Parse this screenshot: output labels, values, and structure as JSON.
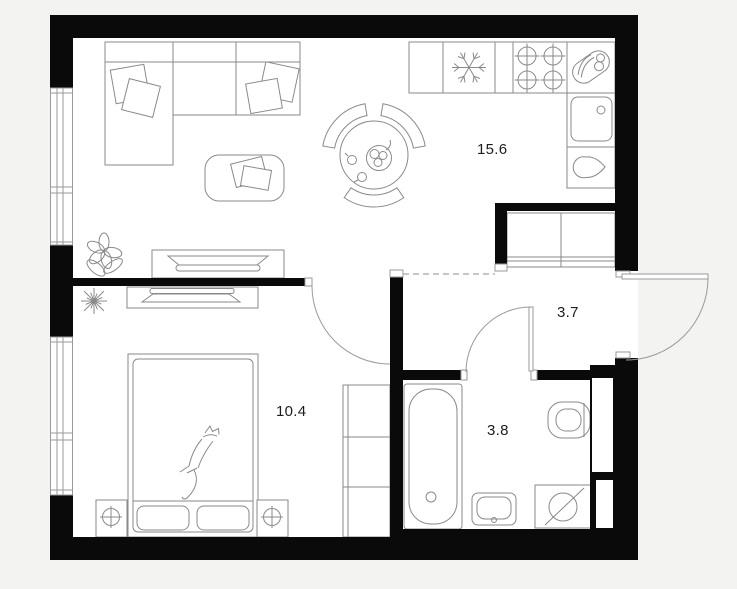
{
  "rooms": [
    {
      "name": "living-room-with-kitchen",
      "area_label": "15.6"
    },
    {
      "name": "bedroom",
      "area_label": "10.4"
    },
    {
      "name": "hallway",
      "area_label": "3.7"
    },
    {
      "name": "bathroom",
      "area_label": "3.8"
    }
  ],
  "colors": {
    "background": "#f3f3f1",
    "floor": "#ffffff",
    "walls": "#0a0a0a",
    "furniture_lines": "#8a8a8a",
    "labels": "#1d1d1d"
  },
  "icons": {
    "kitchen": [
      "fridge-icon",
      "stove-burners-icon",
      "kitchen-sink-icon",
      "kettle-icon",
      "fruit-plate-icon"
    ],
    "living_room": [
      "corner-sofa",
      "sofa-cushions",
      "coffee-table",
      "magazine",
      "tv-stand",
      "dining-table",
      "dining-chairs",
      "fruit-bowl-icon",
      "orchid-plant-icon"
    ],
    "bedroom": [
      "double-bed",
      "pillows",
      "cat-sketch",
      "nightstands",
      "table-lamp-icon",
      "wardrobe",
      "dresser-tv",
      "spiky-plant-icon"
    ],
    "bathroom": [
      "bathtub",
      "toilet",
      "washbasin",
      "washing-machine-icon",
      "duct-shaft"
    ],
    "hallway": [
      "hall-wardrobe",
      "entrance-door",
      "interior-doors",
      "zone-dashed-line",
      "windows"
    ]
  }
}
